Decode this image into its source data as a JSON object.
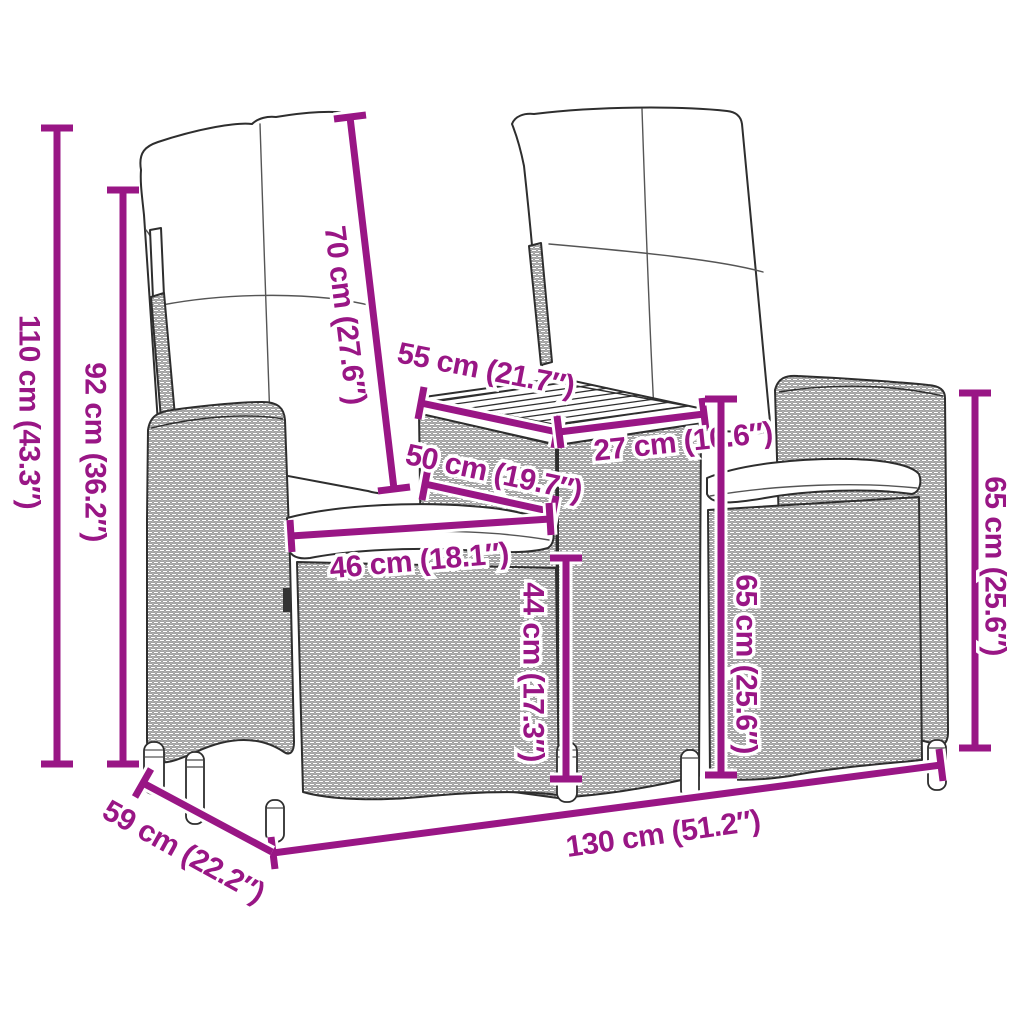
{
  "colors": {
    "accent": "#991685",
    "line_art": "#2e2e2e",
    "background": "#ffffff"
  },
  "dimensions": {
    "total_height": {
      "label": "110 cm (43.3″)"
    },
    "backrest_height": {
      "label": "92 cm (36.2″)"
    },
    "back_cushion": {
      "label": "70 cm (27.6″)"
    },
    "table_length": {
      "label": "55 cm (21.7″)"
    },
    "seat_surface": {
      "label": "50 cm (19.7″)"
    },
    "seat_width": {
      "label": "46 cm (18.1″)"
    },
    "table_depth": {
      "label": "27 cm (10.6″)"
    },
    "seat_height": {
      "label": "44 cm (17.3″)"
    },
    "table_height": {
      "label": "65 cm (25.6″)"
    },
    "armrest_height": {
      "label": "65 cm (25.6″)"
    },
    "total_width": {
      "label": "130 cm (51.2″)"
    },
    "total_depth": {
      "label": "59 cm (22.2″)"
    }
  }
}
